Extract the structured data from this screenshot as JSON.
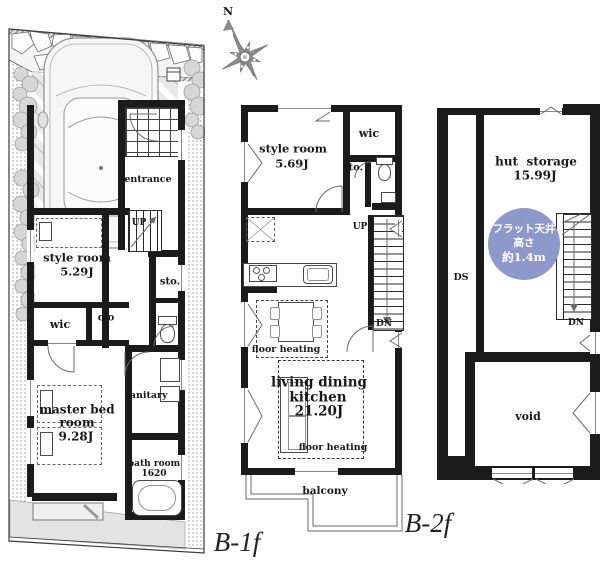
{
  "colors": {
    "wall": "#1b1b1b",
    "blue_badge": "#8e99cb",
    "garden": "#e3e3e3",
    "parking": "#e9e9e9"
  },
  "compass": {
    "north_label": "N"
  },
  "plan_b1f": {
    "floor_label": "B-1f",
    "entrance_label": "entrance",
    "up_label": "UP",
    "style_room_name": "style room",
    "style_room_area": "5.29J",
    "wic_label": "wic",
    "clo_label": "clo",
    "sto_label": "sto.",
    "master_bed_line1": "master bed",
    "master_bed_line2": "room",
    "master_bed_area": "9.28J",
    "sanitary_label": "sanitary",
    "bath_room_name": "bath room",
    "bath_room_size": "1620"
  },
  "plan_b2f": {
    "floor_label": "B-2f",
    "style_room_name": "style room",
    "style_room_area": "5.69J",
    "wic_label": "wic",
    "sto_label": "sto.",
    "up_label": "UP",
    "dn_label": "DN",
    "floor_heating_dining": "floor heating",
    "ldk_line1": "living dining",
    "ldk_line2": "kitchen",
    "ldk_area": "21.20J",
    "floor_heating_living": "floor heating",
    "balcony_label": "balcony"
  },
  "plan_loft": {
    "hut_storage_name": "hut  storage",
    "hut_storage_area": "15.99J",
    "ceiling_badge_line1": "フラット天井",
    "ceiling_badge_line2": "高さ",
    "ceiling_badge_line3": "約1.4m",
    "ds_label": "DS",
    "dn_label": "DN",
    "void_label": "void"
  }
}
